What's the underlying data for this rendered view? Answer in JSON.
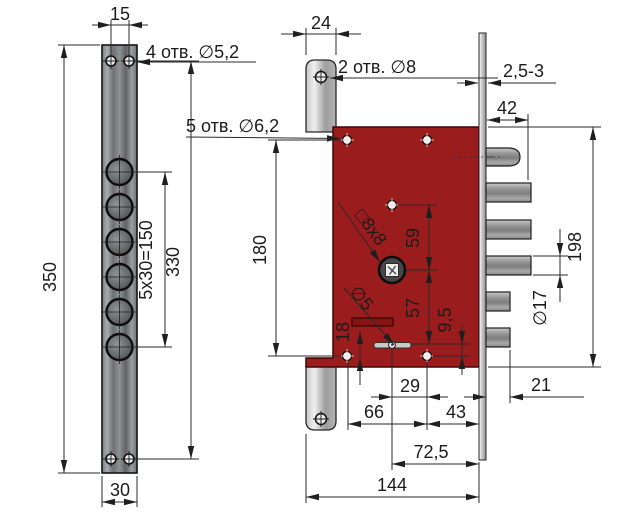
{
  "drawing": {
    "type": "engineering-dimension-drawing",
    "subject": "mortise door lock with faceplate strip, lock body, latch and deadbolts",
    "colors": {
      "background": "#FFFFFF",
      "lock_body_red": "#9B1C1C",
      "metal_gray": "#8C9093",
      "dimension_line": "#2A2A2A",
      "text": "#1B1B1B"
    },
    "labels": {
      "holes4": "4 отв. ∅5,2",
      "holes2": "2 отв. ∅8",
      "holes5": "5 отв. ∅6,2",
      "square_spindle": "□8x8",
      "pin_dia": "∅5",
      "bolt_dia": "∅17",
      "plate_thickness": "2,5-3"
    },
    "dims": {
      "strip_hole_spacing": "15",
      "strip_height": "350",
      "strip_hole_span": "330",
      "strip_big_hole_pattern": "5x30=150",
      "strip_width": "30",
      "post_width": "24",
      "bolt_throw": "42",
      "body_hole_span_vertical": "180",
      "hole_to_spindle": "59",
      "spindle_to_lever": "57",
      "lever_to_hole": "9,5",
      "slot_offset": "18",
      "lever_pivot_offset": "29",
      "aux_bolt_throw": "21",
      "hole_span_horizontal": "66",
      "hole_to_faceplate": "43",
      "backset": "72,5",
      "body_depth": "144",
      "body_height": "198"
    }
  }
}
